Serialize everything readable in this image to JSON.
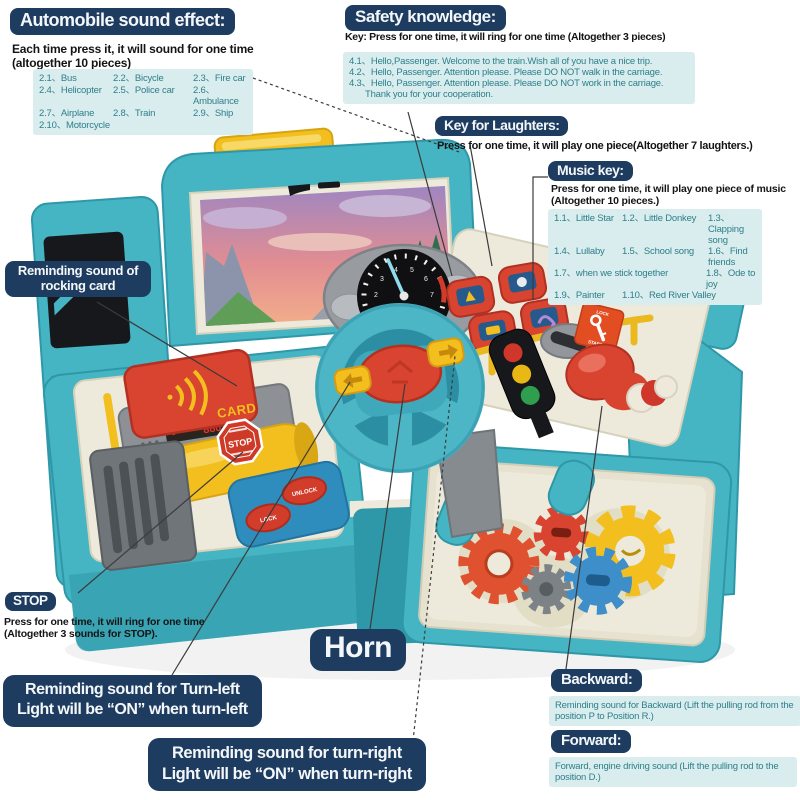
{
  "colors": {
    "pill_bg": "#1e3c5f",
    "pill_text": "#f4f7fa",
    "info_bg": "#d9edee",
    "info_text": "#2e7f8a",
    "body_text": "#141414",
    "line": "#3b3b3b",
    "teal": "#45b4c3",
    "teal_dark": "#2f98a8",
    "cream": "#eeeadb",
    "cream_dark": "#d6d1ba",
    "red": "#d8442f",
    "yellow": "#f2bf1e",
    "blue": "#2e8dbd",
    "gray": "#8d9196",
    "dark": "#17181c"
  },
  "callouts": {
    "automobile": {
      "title": "Automobile sound effect:",
      "desc": "Each time press it, it will sound for one time (altogether 10 pieces)",
      "items": [
        "2.1、Bus",
        "2.2、Bicycle",
        "2.3、Fire car",
        "2.4、Helicopter",
        "2.5、Police car",
        "2.6、Ambulance",
        "2.7、Airplane",
        "2.8、Train",
        "2.9、Ship",
        "2.10、Motorcycle"
      ]
    },
    "safety": {
      "title": "Safety knowledge:",
      "key_line": "Key: Press for one time, it will ring for one time (Altogether 3 pieces)",
      "lines": [
        "4.1、Hello,Passenger. Welcome to the train.Wish all of you have a nice trip.",
        "4.2、Hello, Passenger. Attention please. Please DO NOT walk in the carriage.",
        "4.3、Hello, Passenger. Attention please. Please DO NOT work in the carriage.",
        "Thank you for your cooperation."
      ]
    },
    "laughters": {
      "title": "Key for Laughters:",
      "desc": "Press for one time, it will play one piece(Altogether 7 laughters.)"
    },
    "music": {
      "title": "Music key:",
      "desc": "Press for one time, it will play one piece of music (Altogether 10 pieces.)",
      "rows": [
        [
          "1.1、Little Star",
          "1.2、Little Donkey",
          "1.3、Clapping song"
        ],
        [
          "1.4、Lullaby",
          "1.5、School song",
          "1.6、Find friends"
        ],
        [
          "1.7、when we stick together",
          "1.8、Ode to joy"
        ],
        [
          "1.9、Painter",
          "1.10、Red River Valley"
        ]
      ]
    },
    "rocking": {
      "line1": "Reminding sound of",
      "line2": "rocking card"
    },
    "stop": {
      "title": "STOP",
      "desc": "Press for one time, it will ring for one time (Altogether 3 sounds for STOP)."
    },
    "horn": {
      "title": "Horn"
    },
    "turn_left": {
      "line1": "Reminding sound for Turn-left",
      "line2": "Light will be “ON” when turn-left"
    },
    "turn_right": {
      "line1": "Reminding sound for turn-right",
      "line2": "Light will be “ON” when turn-right"
    },
    "backward": {
      "title": "Backward:",
      "desc": "Reminding sound for Backward (Lift the pulling rod from the position P to Position R.)"
    },
    "forward": {
      "title": "Forward:",
      "desc": "Forward, engine driving sound (Lift the pulling rod to the position D.)"
    }
  },
  "toy": {
    "card_label": "CARD",
    "display_value": "880",
    "stop_sticker": "STOP",
    "ignition_lock": "LOCK",
    "ignition_start": "START",
    "lock_button": "LOCK",
    "unlock_button": "UNLOCK",
    "dial_numbers": [
      "1",
      "2",
      "3",
      "4",
      "5",
      "6",
      "7",
      "8"
    ]
  }
}
